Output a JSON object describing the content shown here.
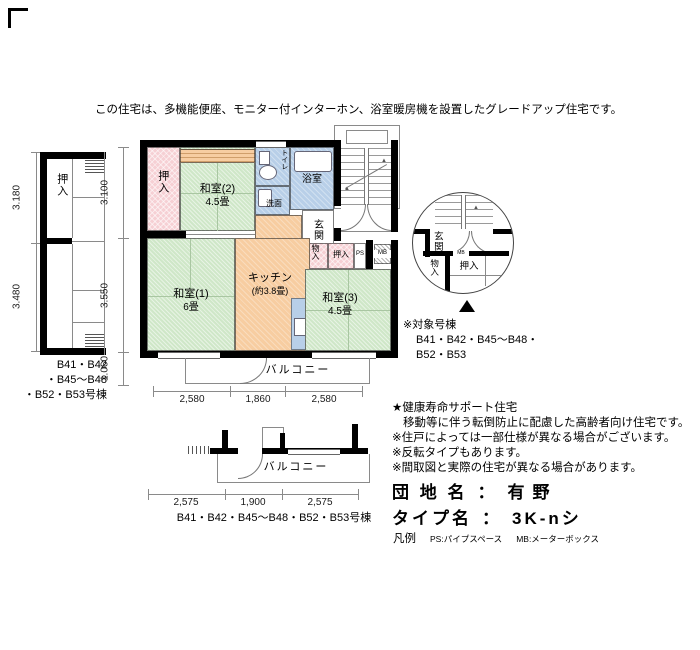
{
  "colors": {
    "tatami": "#cfe7c8",
    "wet": "#b8cfe8",
    "closet": "#f6d0d4",
    "kitchen": "#f7cda1",
    "wall": "#000000",
    "line": "#8a8a8a"
  },
  "header": {
    "description": "この住宅は、多機能便座、モニター付インターホン、浴室暖房機を設置したグレードアップ住宅です。"
  },
  "left_plan": {
    "dim_top": "3.180",
    "dim_bottom": "3.480",
    "closet": "押入",
    "caption1": "B41・B42",
    "caption2": "・B45〜B48",
    "caption3": "・B52・B53号棟"
  },
  "main_plan": {
    "dim_v1": "3.100",
    "dim_v2": "3.550",
    "dim_v3": "1.060",
    "dim_b1": "2,580",
    "dim_b2": "1,860",
    "dim_b3": "2,580",
    "oshiire_left": "押入",
    "washitsu2_name": "和室(2)",
    "washitsu2_size": "4.5畳",
    "toilet": "トイレ",
    "senmen": "洗面",
    "bath": "浴室",
    "genkan": "玄関",
    "monoire": "物入",
    "oshiire2": "押入",
    "ps": "PS",
    "mb": "MB",
    "shelf_note": "下段棚",
    "kitchen_name": "キッチン",
    "kitchen_size": "(約3.8畳)",
    "washitsu1_name": "和室(1)",
    "washitsu1_size": "6畳",
    "washitsu3_name": "和室(3)",
    "washitsu3_size": "4.5畳",
    "balcony": "バルコニー"
  },
  "lower_plan": {
    "balcony": "バルコニー",
    "dim1": "2,575",
    "dim2": "1,900",
    "dim3": "2,575",
    "caption": "B41・B42・B45〜B48・B52・B53号棟"
  },
  "detail": {
    "genkan": "玄関",
    "mb": "MB",
    "monoire": "物入",
    "oshiire": "押入",
    "note_title": "※対象号棟",
    "note_line1": "B41・B42・B45〜B48・",
    "note_line2": "B52・B53"
  },
  "notes": {
    "l1": "★健康寿命サポート住宅",
    "l2": "移動等に伴う転倒防止に配慮した高齢者向け住宅です。",
    "l3": "※住戸によっては一部仕様が異なる場合がございます。",
    "l4": "※反転タイプもあります。",
    "l5": "※間取図と実際の住宅が異なる場合があります。"
  },
  "summary": {
    "site_label": "団 地 名",
    "colon": "：",
    "site_value": "有野",
    "type_label": "タイプ名",
    "type_value": "3K-nシ",
    "legend_label": "凡例",
    "legend_ps": "PS:パイプスペース",
    "legend_mb": "MB:メーターボックス"
  }
}
